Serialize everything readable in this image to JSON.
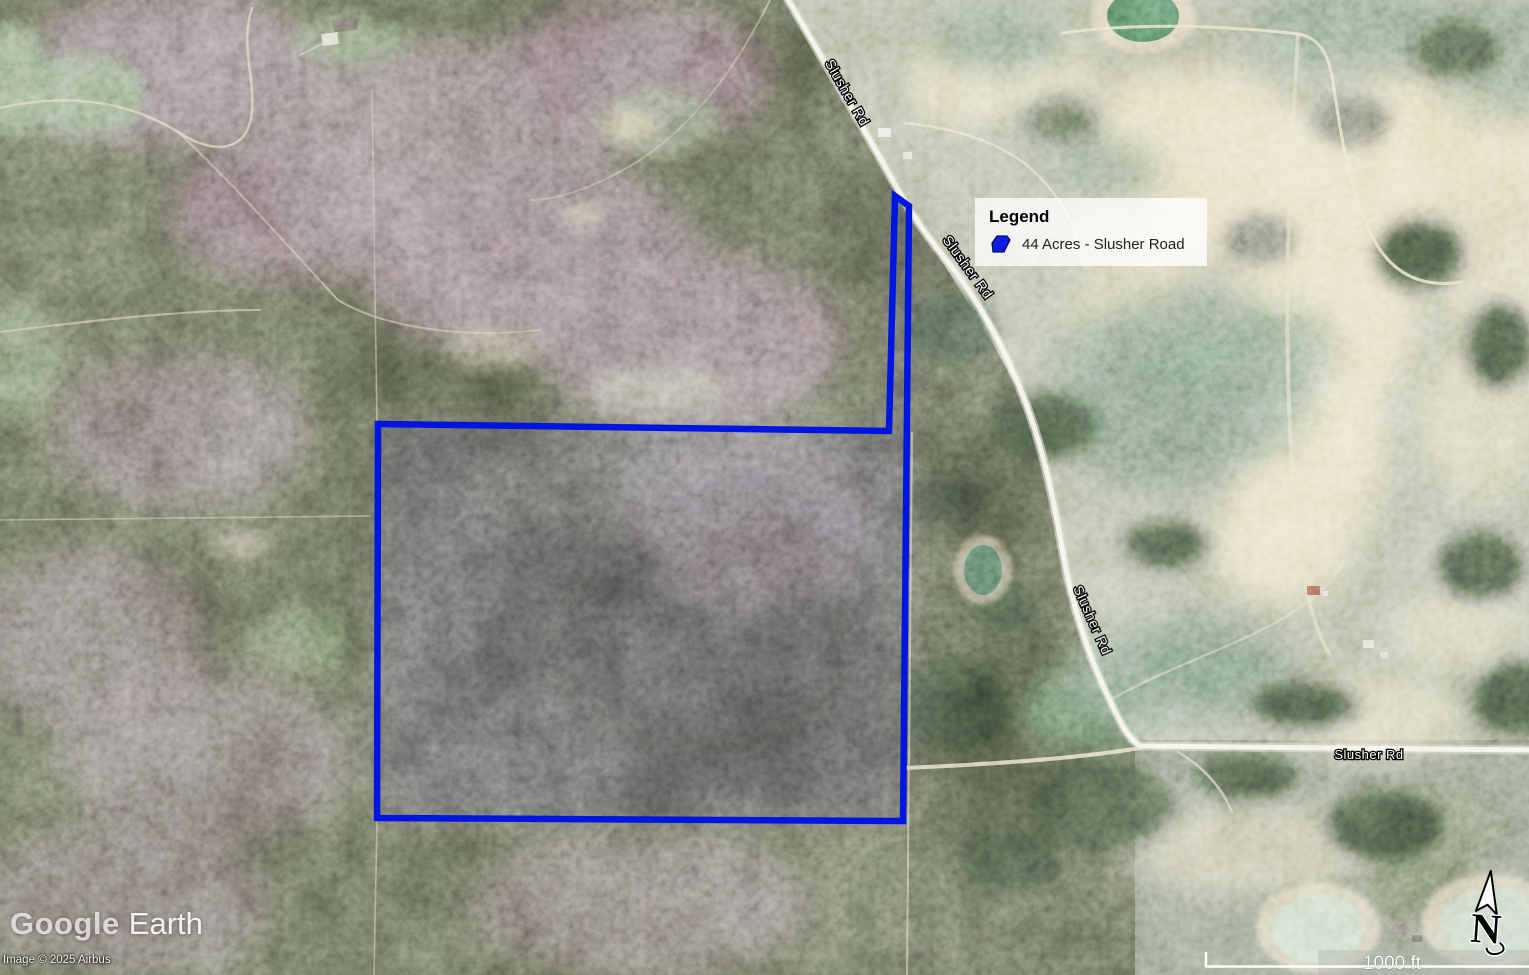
{
  "map": {
    "road_label": "Slusher Rd",
    "watermark": {
      "google": "Google",
      "earth": "Earth"
    },
    "copyright": "Image © 2025 Airbus",
    "scale_label": "1000 ft",
    "north_label": "N"
  },
  "legend": {
    "title": "Legend",
    "items": [
      {
        "label": "44 Acres - Slusher Road",
        "color": "#0d1ddd"
      }
    ]
  },
  "colors": {
    "parcel_outline": "#0016e0",
    "road": "#f5f2e6",
    "legend_background": "rgba(255,255,255,0.78)"
  }
}
